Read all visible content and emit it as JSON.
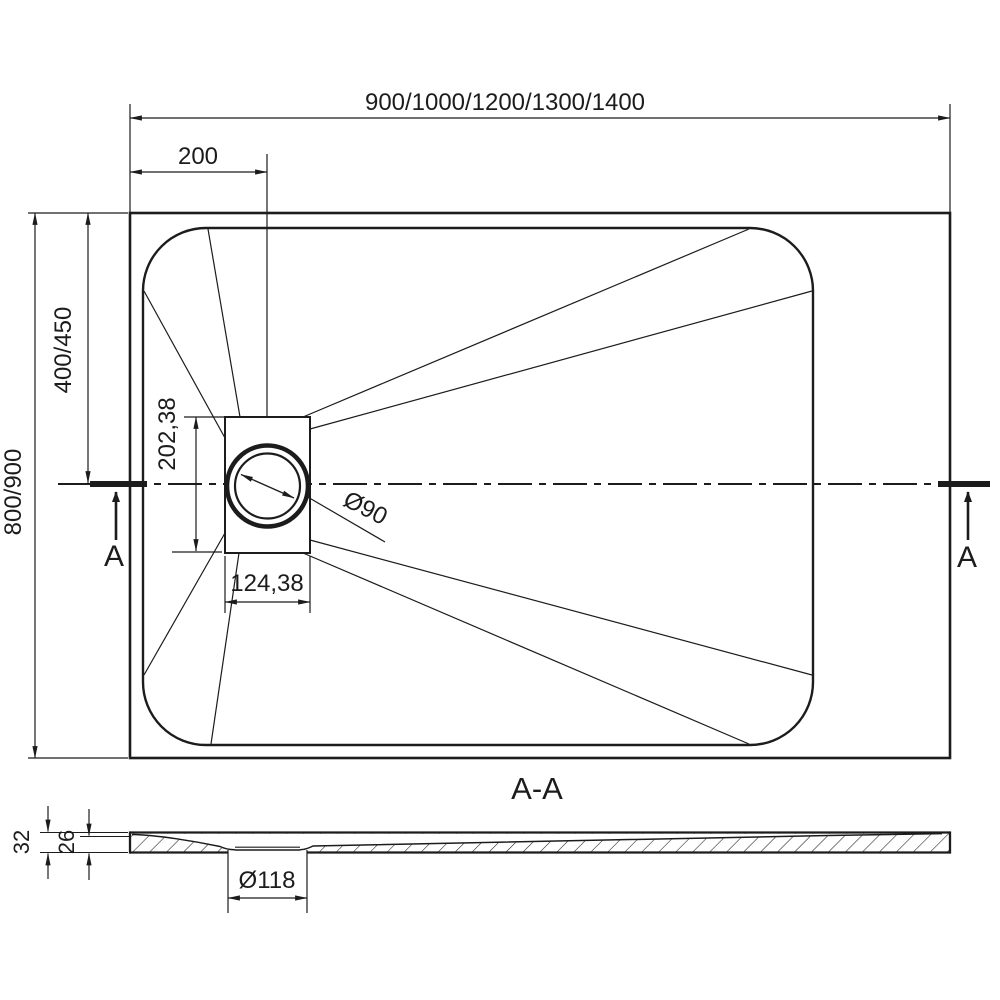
{
  "drawing": {
    "colors": {
      "ink": "#1c1c1c",
      "background": "#ffffff"
    },
    "plan": {
      "dim_overall_width": "900/1000/1200/1300/1400",
      "dim_drain_offset": "200",
      "dim_half_depth": "400/450",
      "dim_overall_depth": "800/900",
      "dim_drain_box_height": "202,38",
      "dim_drain_box_width": "124,38",
      "dim_drain_diameter": "Ø90",
      "section_marker_left": "A",
      "section_marker_right": "A"
    },
    "section": {
      "label": "A-A",
      "dim_total_thickness": "32",
      "dim_inner_thickness": "26",
      "dim_drain_hole_diameter": "Ø118"
    }
  }
}
